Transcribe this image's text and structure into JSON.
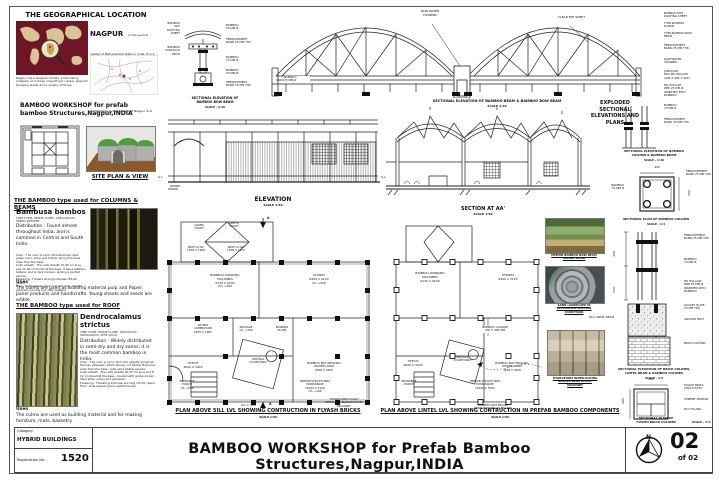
{
  "colors": {
    "map_sea": "#6e1626",
    "map_land": "#d8c495",
    "view_green": "#4f9e3c",
    "ground_brown": "#8a5a2b",
    "linework": "#1a1a1a"
  },
  "geo": {
    "title": "THE GEOGRAPHICAL LOCATION",
    "city": "NAGPUR",
    "city_text": "is the second capital of Maharashtra state in India. It is a cleanest and green city of India. Though NOT a Smartcity, a fine example of modern architecture is the symbol of Nagpur. It is known for a big hub for Maharashtra companies.",
    "map_caption": "Nagpur has a pleasant climate, a fascinating amalgam of cultures, magnificent cuisine, splendid shopping plazas and a variety of things."
  },
  "site": {
    "heading": "BAMBOO WORKSHOP for prefab\nbamboo Structures,Nagpur,INDIA",
    "caption": "SITE PLAN & VIEW"
  },
  "bamboo_cb": {
    "title": "THE BAMBOO type used for COLUMNS & BEAMS",
    "species": "Bambusa bambos",
    "subtitle": "TREE FORM, DENSE CLUMP, GREGARIOUS, SPINES PRESENT",
    "distribution": "Distribution : Found almost throughout India, and is common in Central and South India.",
    "details": "Color : The culm is up to 30 metres tall, dark green color, shiny and hollow. Spiny branches arise from the base.\nCulm sheath : The culm sheath 15-45 cm long and 15-30 cm broad at the base. It has a leathery texture, and is dark maroon, lacking a perfect auricle.\nFlowering : Flowers at long intervals (45-60 years).\nFruit : Oval-seeded grain, 5-8 mm long, smooth grooved one side and often beaked.",
    "uses_title": "Uses",
    "uses": "The culms are used as building material,pulp and Paper, panel products and handicrafts. Young shoots and seeds are  edible."
  },
  "bamboo_roof": {
    "title": "THE BAMBOO type used for ROOF",
    "species": "Dendrocalamus\nstrictus",
    "subtitle": "TREE FORM, DENSE CLUMP, DECIDUOUS, GREGARIOUS, SEMI-SOLID",
    "distribution": "Distribution : Widely distributed in semi-dry and dry zones; it is the most common bamboo in India.",
    "details": "Color : The culm is up to 16 m tall, slightly arched at the top, yellowish, which strong, not hollow. Branches arise from the base; node veins bellow spread.\nCulm sheath : The culm sheath 10-25 cm long and 8-12 cm broad at the base, covered with golden brown hairs when young and yellowish.\nFlowering : Flowering intervals are long (25-45 years).\nFruit : Oval-seeded grain, seeded brown.",
    "uses_title": "Uses",
    "uses": "The culms are used as building material and for making furniture, mats, basketry."
  },
  "bow_detail": {
    "label_roof_sheet": "BAMBOO MAT\nROOFING SHEET",
    "label_purlin": "BAMBOO\nPURLIN 50 MM Ø",
    "label_b50_top": "BAMBOO\n50 MM Ø",
    "label_ferro_top": "FERROCEMENT\nBAND 25 MM THK",
    "label_b70": "BAMBOO\n70 MM Ø",
    "label_b50_bot": "BAMBOO\n50 MM Ø",
    "label_ferro_bot": "FERROCEMENT\nBAND 25 MM THK",
    "caption": "SECTIONAL ELEVATION OF\nBAMBOO BOW BEAM",
    "scale": "SCALE - 1:10"
  },
  "arch": {
    "label_rain": "RAIN WATER\nCHANNEL",
    "label_frp": "CLEAR FRP SHEET",
    "label_b70": "BAMBOO\n70 MM Ø",
    "caption": "SECTIONAL ELEVATION OF BAMBOO  BEAM & BAMBOO BOW BEAM",
    "scale": "SCALE  1:10"
  },
  "exploded": {
    "heading": "EXPLODED\nSECTIONAL\nELEVATIONS AND\nPLANS",
    "labels": {
      "roof_sheet": "BAMBOO MAT\nROOFING SHEET",
      "purlin": "THIN BAMBOO\nPURLIN",
      "bow_beam": "THIN BAMBOO BOW\nBEAM",
      "ferro_a": "FERROCEMENT\nBAND 25 MM THK",
      "rain": "RAIN WATER\nCHANNEL",
      "junction": "JUNCTION\nBOX,MS HOLLOW\n(400 X 400 X 400)",
      "ms_pipe_a": "MS HOLLOW\nPIPE 25 MM Ø,\nINSERTED INTO\nBAMBOO",
      "b70_a": "BAMBOO\n70 MM Ø",
      "ferro_b": "FERROCEMENT\nBAND 25 MM THK",
      "b70_b": "BAMBOO\n70 MM Ø",
      "ferro_c": "FERROCEMENT\nBAND 25 MM THK",
      "ferro_d": "FERROCEMENT\nBAND 25 MM THK",
      "b70_c": "BAMBOO\n70 MM Ø",
      "ms_pipe_b": "MS HOLLOW\nPIPE 25 MM Ø,\nINSERTED INTO\nBAMBOO",
      "gusset": "GUSSET PLATE\n25 MM THK",
      "anchor": "ANCHOR BOLT",
      "rcc": "RCC LINTEL BEAM",
      "brick_col": "BRICK COLUMN",
      "flyash": "FLYASH BRICK\n230X115X75",
      "mortar": "CEMENT MORTAR",
      "pcc": "PCC FILLING"
    },
    "dim400a": "400",
    "dim400b": "400",
    "dim400c": "400",
    "dim400d": "400",
    "dim300": "300",
    "dim550": "550",
    "cap_col_beam": "SECTIONAL ELEVATION OF BAMBOO\nCOLUMN & BAMBOO BEAM",
    "cap_col_beam_scale": "SCALE - 1:10",
    "cap_plan_col": "SECTIONAL PLAN OF BAMBOO COLUMN",
    "cap_plan_col_scale": "SCALE - 1:4",
    "cap_brick_elev": "SECTIONAL ELEVATION  OF  BRICK COLUMN,\nLINTEL BEAM & BAMBOO COLUMN",
    "cap_brick_elev_scale": "SCALE - 1:4",
    "cap_brick_plan": "SECTIONAL PLAN OF\nFLYASH BRICK COLUMN",
    "cap_brick_plan_scale": "SCALE - 1:4"
  },
  "elevation": {
    "caption": "ELEVATION",
    "scale": "SCALE  1:50",
    "gl_left": "G.L.",
    "gl_right": "G.L."
  },
  "section": {
    "caption": "SECTION AT  AA'",
    "scale": "SCALE  1:50"
  },
  "plan_sill": {
    "marker_a": "A",
    "marker_a1": "A'",
    "rooms": {
      "ladies": "LADIES\nTOILET",
      "gents": "GENTS\nTOILET",
      "bath1": "BATH & WC\n1500 X 1965",
      "bath2": "BATH & WC\n1500 X 1972",
      "machines": "BAMBOO WORKING\nMACHINES\n6125 X 9100\nC/L +300",
      "stores": "STORES\n6400 X 3120\nC/L +300",
      "supervisor": "WORKS\nSUPERVISOR\n2550 X 1965",
      "passage": "PASSAGE\nC/L +300",
      "plant": "BAMBOO\nPLANT",
      "office": "OFFICE\n4000 X 3945",
      "courtyard": "CENTRAL\nCOURTYARD",
      "loom": "BAMBOO MAT WEAVING\nPOWER LOOM\n4500 X 3940",
      "porch": "ENTRANCE\nPORCH\nC/L +300",
      "workspace": "PREFAB STRUCTURES\nWORKSPACE\n10100 X 5100\nC/L +300",
      "lvl": "LVL ± 0.00",
      "note": "HYDRAFORM FLYASH\nINTERLOCK BLOCKS IN DRY\nMASONRY"
    },
    "caption": "PLAN ABOVE SILL LVL SHOWING CONTRUCTION IN FLYASH BRICKS",
    "scale": "SCALE  1:50"
  },
  "plan_lintel": {
    "rooms": {
      "machines": "BAMBOO WORKING\nMACHINES\n6125 X 9100",
      "stores": "STORES\n6400 X 3120",
      "office": "OFFICE\n4000 X 3945",
      "courtyard": "CENTRAL\nCOURTYARD",
      "loom": "BAMBOO MAT WEAVING\nPOWER LOOM\n4500 X 3940",
      "porch": "ENTRANCE\nPORCH",
      "workspace": "PREFAB STRUCTURES\nWORKSPACE\n10100 X 5100",
      "column": "BAMBOO COLUMN\n400 X 400 MM",
      "board": "BAMBOO  MAT  BOARD\nRESIN BONDED 40 MM THK"
    },
    "caption": "PLAN ABOVE LINTEL LVL SHOWING  CONTRUCTION IN PREFAB BAMBOO COMPONENTS",
    "scale": "SCALE  1:50"
  },
  "photos": {
    "p1": "PREFAB BAMBOO BOW BEAM\n(SHORT SPAN)",
    "p2": "SAND LANDSCAPE IN\nSKYLIGHTED CENTRAL\nCOURTYARD",
    "p3": "HYDRAFORM INTERLOCKING\nBLOCKS  WALL IN DRY\nMASONRY"
  },
  "titlebar": {
    "category_label": "Category",
    "category_value": "HYBRID BUILDINGS",
    "reg_label": "Registration No.  :",
    "reg_value": "1520",
    "title": "BAMBOO WORKSHOP for Prefab Bamboo Structures,Nagpur,INDIA",
    "north": "N",
    "page_num": "02",
    "page_of": "of 02"
  }
}
